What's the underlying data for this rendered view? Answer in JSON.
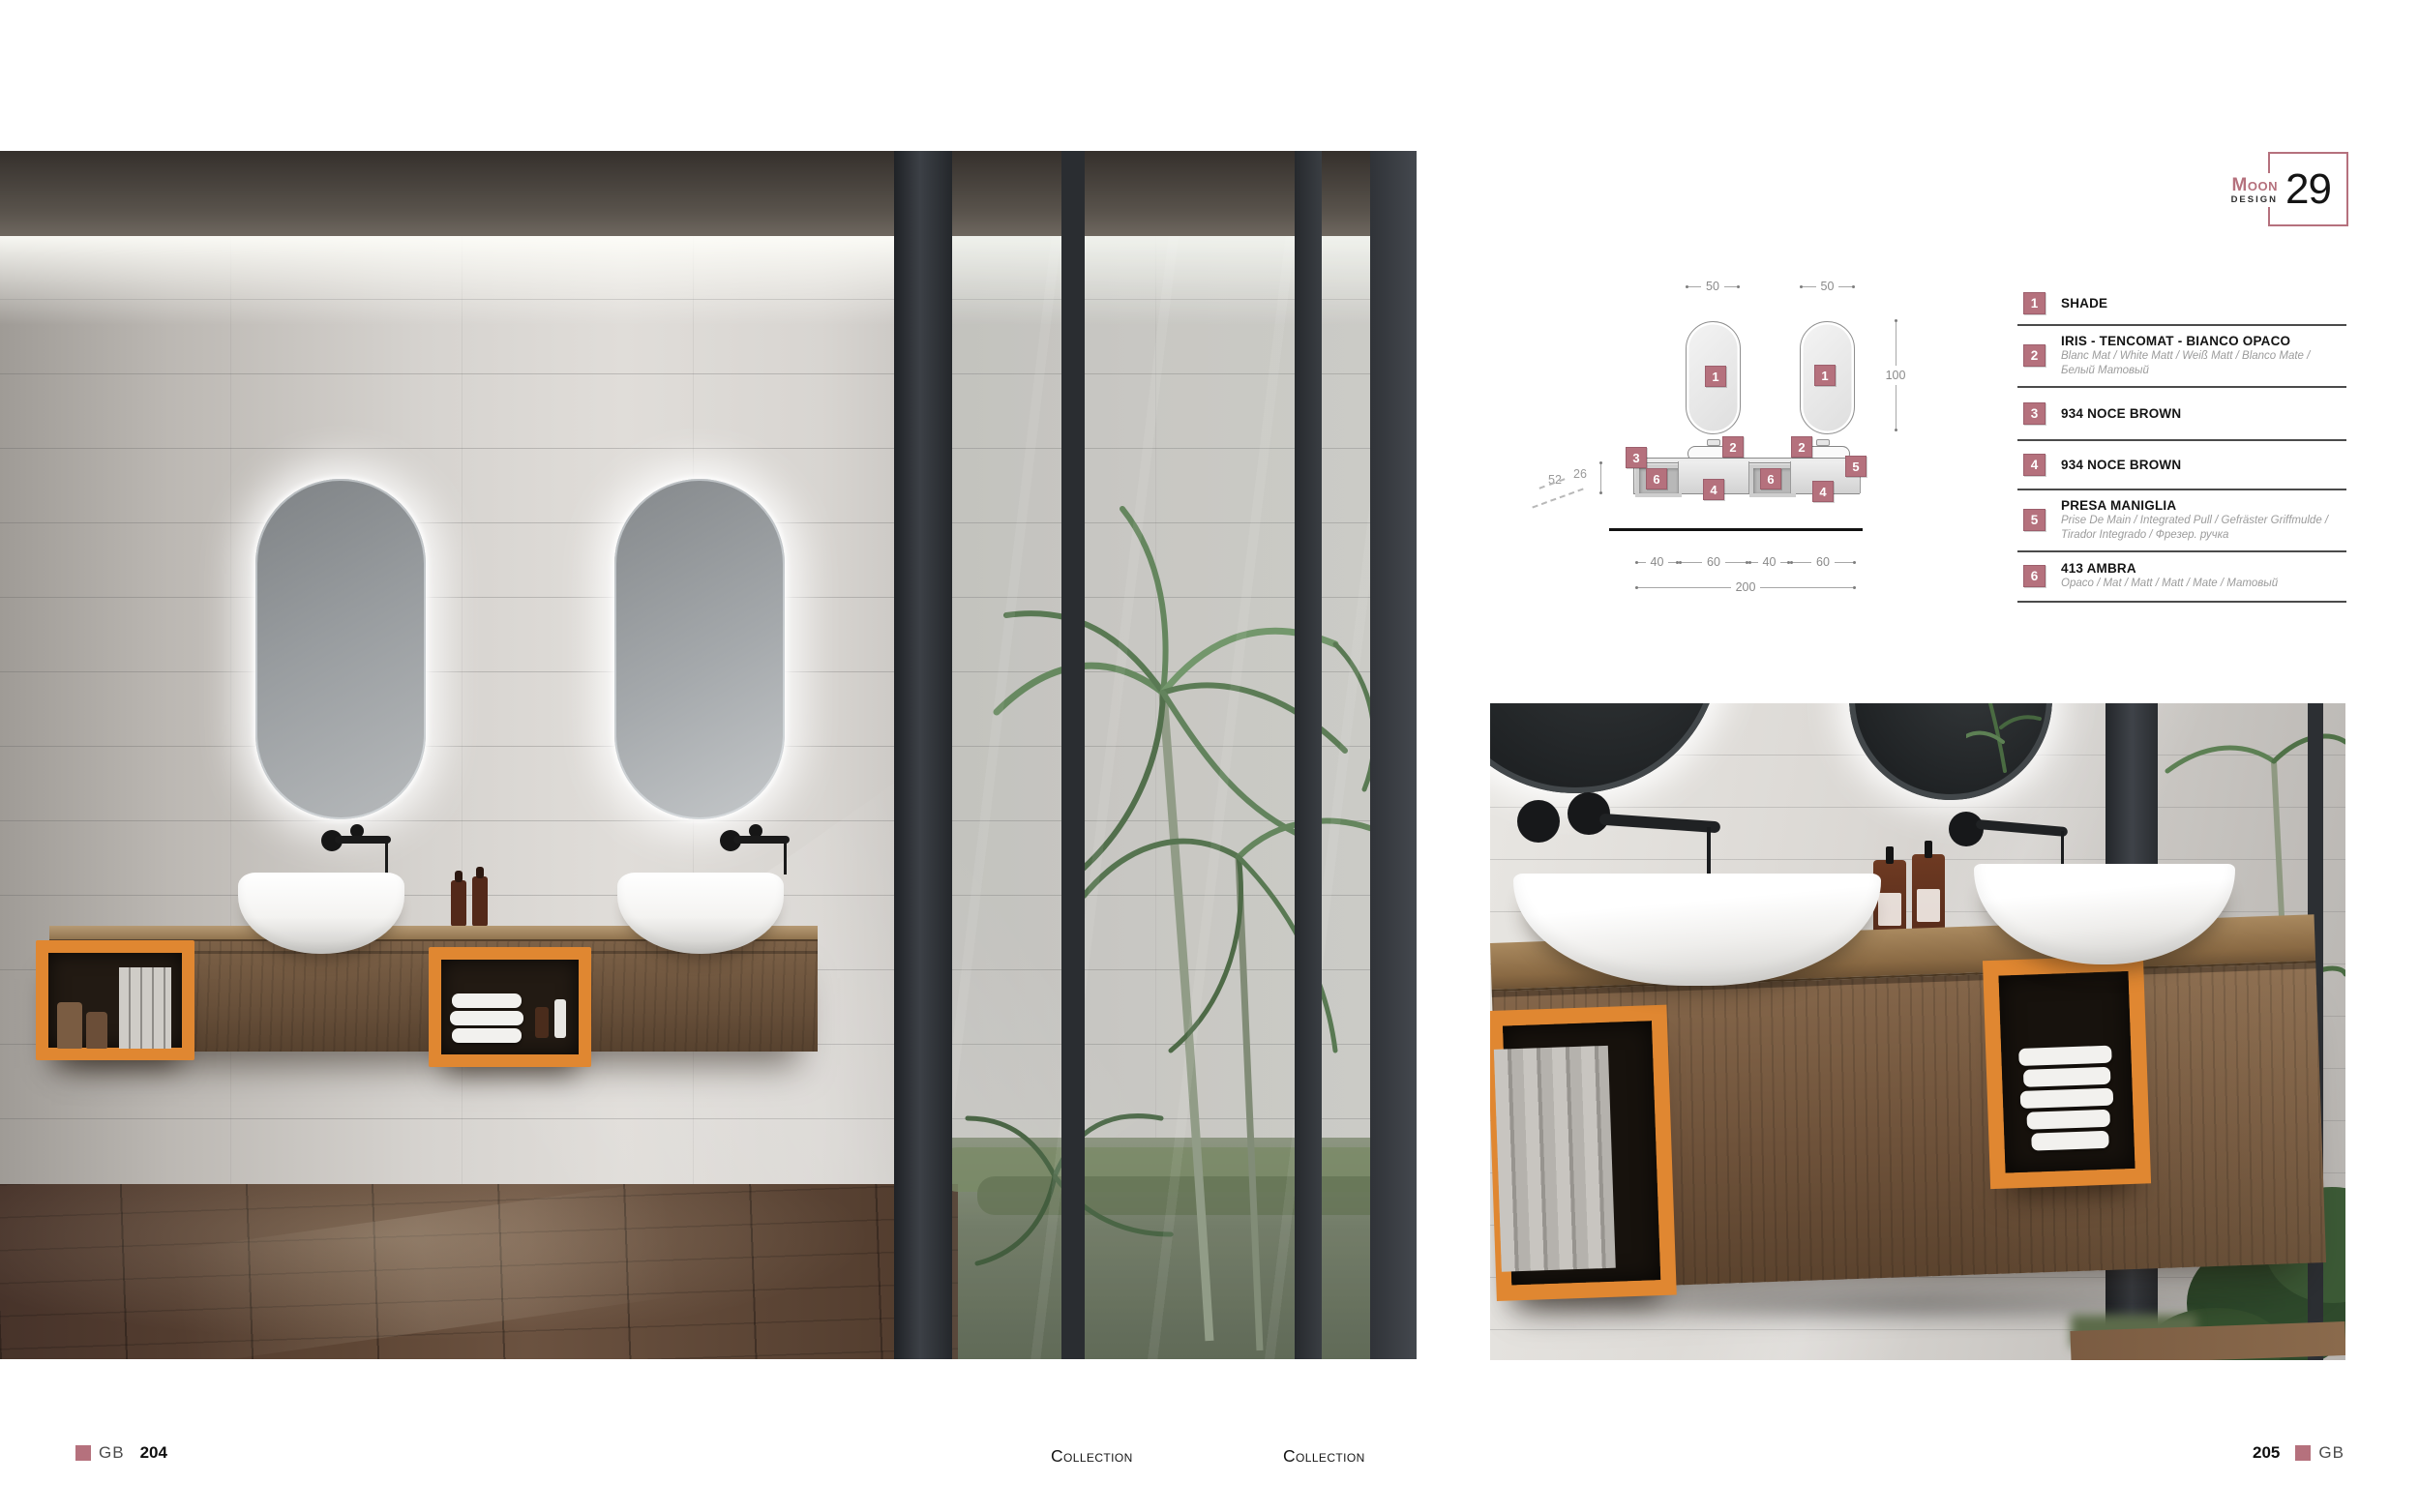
{
  "colors": {
    "accent_pink": "#b5717d",
    "accent_orange": "#e08731"
  },
  "brand_badge": {
    "name": "Moon",
    "sub": "Design",
    "number": "29"
  },
  "drawing": {
    "dims": {
      "mirror_w_left": "50",
      "mirror_w_right": "50",
      "mirror_h": "100",
      "depth": "52",
      "cabinet_h": "26",
      "bottom_segments": [
        "40",
        "60",
        "40",
        "60"
      ],
      "total_width": "200"
    },
    "markers": [
      "1",
      "1",
      "2",
      "2",
      "3",
      "5",
      "6",
      "6",
      "4",
      "4"
    ]
  },
  "legend": {
    "items": [
      {
        "num": "1",
        "title": "SHADE",
        "subtitle": ""
      },
      {
        "num": "2",
        "title": "IRIS  - TENCOMAT  - BIANCO OPACO",
        "subtitle": "Blanc Mat / White  Matt / Weiß Matt / Blanco Mate / Белый Матовый"
      },
      {
        "num": "3",
        "title": "934 NOCE BROWN",
        "subtitle": ""
      },
      {
        "num": "4",
        "title": "934 NOCE BROWN",
        "subtitle": ""
      },
      {
        "num": "5",
        "title": "PRESA MANIGLIA",
        "subtitle": "Prise De Main / Integrated Pull / Gefräster Griffmulde / Tirador Integrado / Фрезер. ручка"
      },
      {
        "num": "6",
        "title": "413 AMBRA",
        "subtitle": "Opaco / Mat / Matt / Matt / Mate / Матовый"
      }
    ]
  },
  "footer": {
    "left_brand": "GB",
    "left_page": "204",
    "collection_left": "Collection",
    "collection_right": "Collection",
    "right_page": "205",
    "right_brand": "GB"
  }
}
